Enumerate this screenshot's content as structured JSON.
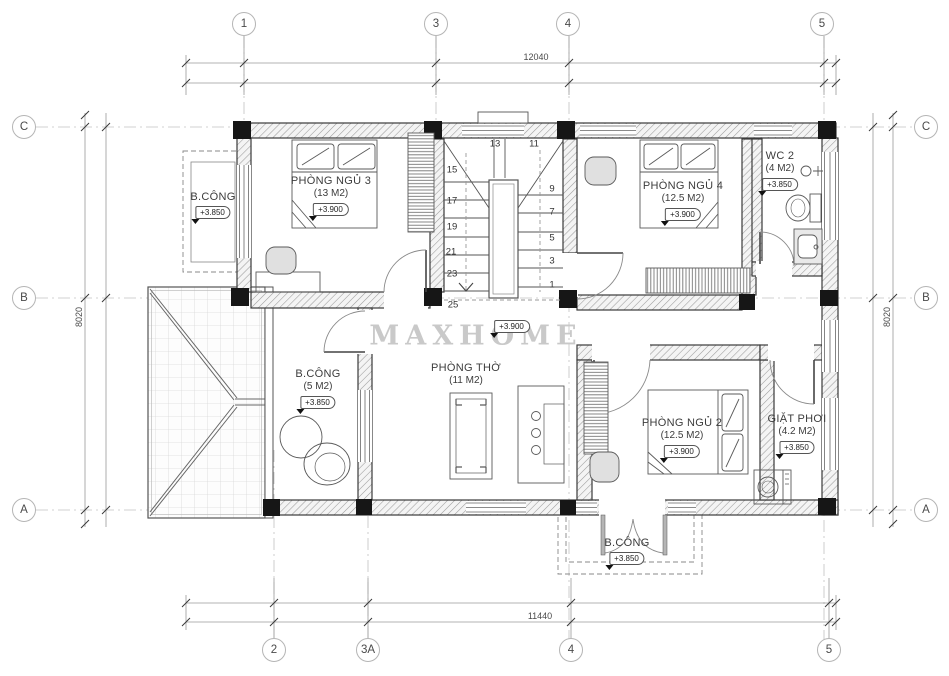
{
  "watermark": "MAXHOME",
  "dimensions": {
    "top": "12040",
    "bottom": "11440",
    "left": "8020",
    "right": "8020"
  },
  "grid": {
    "top": [
      "1",
      "3",
      "4",
      "5"
    ],
    "bottom": [
      "2",
      "3A",
      "4",
      "5"
    ],
    "left": [
      "C",
      "B",
      "A"
    ],
    "right": [
      "C",
      "B",
      "A"
    ]
  },
  "rooms": {
    "bedroom3": {
      "name": "PHÒNG NGỦ 3",
      "area": "(13 M2)",
      "level": "+3.900"
    },
    "bedroom4": {
      "name": "PHÒNG NGỦ 4",
      "area": "(12.5 M2)",
      "level": "+3.900"
    },
    "wc2": {
      "name": "WC 2",
      "area": "(4 M2)",
      "level": "+3.850"
    },
    "balcony_top_left": {
      "name": "B.CÔNG",
      "level": "+3.850"
    },
    "balcony_left": {
      "name": "B.CÔNG",
      "area": "(5 M2)",
      "level": "+3.850"
    },
    "worship": {
      "name": "PHÒNG THỜ",
      "area": "(11 M2)"
    },
    "bedroom2": {
      "name": "PHÒNG NGỦ 2",
      "area": "(12.5 M2)",
      "level": "+3.900"
    },
    "laundry": {
      "name": "GIẶT PHƠI",
      "area": "(4.2 M2)",
      "level": "+3.850"
    },
    "balcony_bottom": {
      "name": "B.CÔNG",
      "level": "+3.850"
    }
  },
  "hall_level": "+3.900",
  "stairs": {
    "numbers": [
      "13",
      "11",
      "15",
      "9",
      "17",
      "7",
      "19",
      "5",
      "21",
      "3",
      "23",
      "1",
      "25"
    ]
  }
}
